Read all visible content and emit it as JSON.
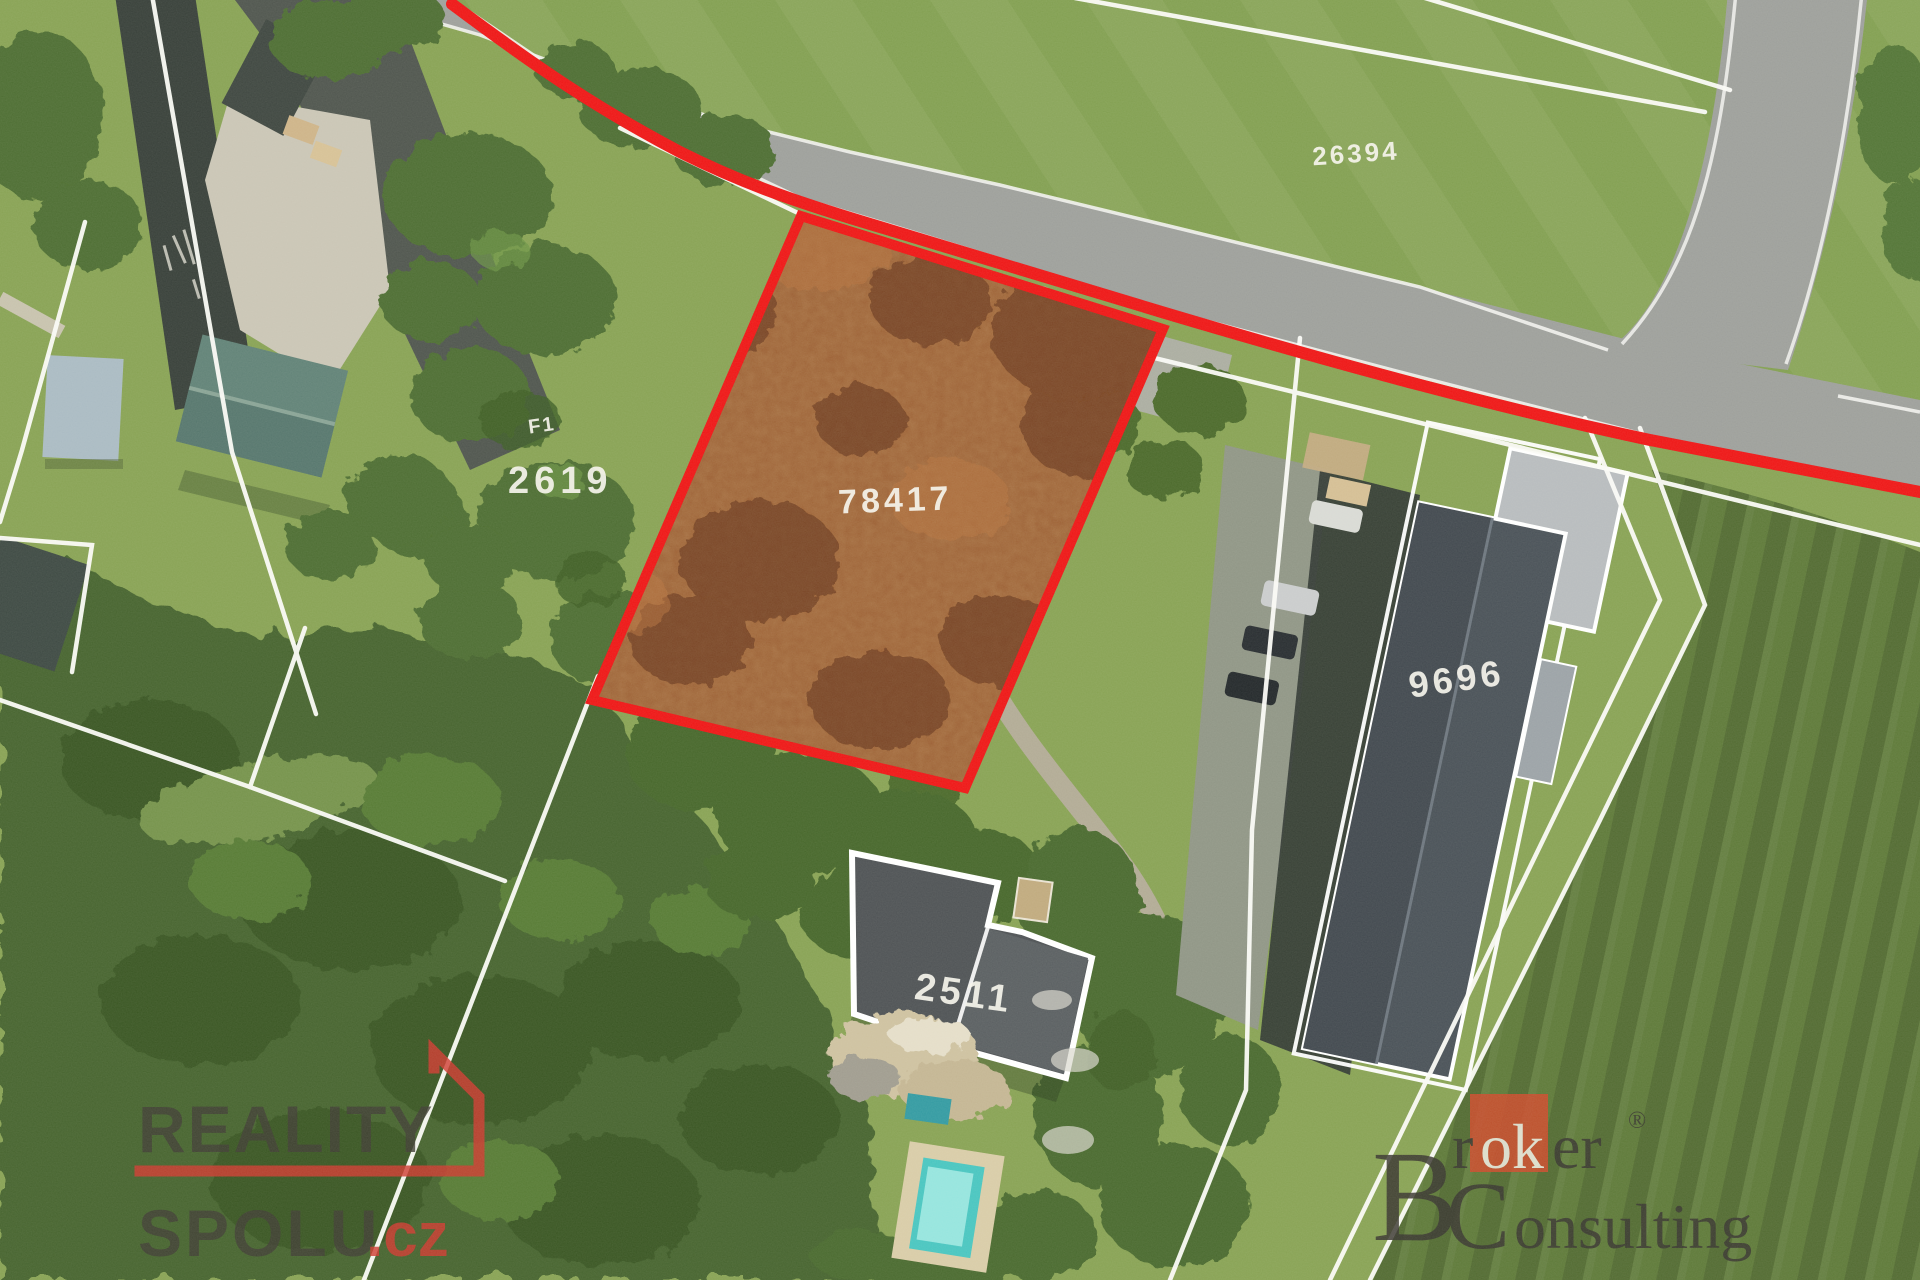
{
  "map": {
    "type": "aerial-cadastral-photo",
    "parcel_labels": {
      "top_right": "26394",
      "left": "2619",
      "highlighted": "78417",
      "building_right": "9696",
      "house_bottom": "2511",
      "small_mark": "F1"
    },
    "highlight": {
      "parcel_number": "78417",
      "outline_color": "#ee1010",
      "road_marker_color": "#ee1010",
      "fill_tint": "#915426"
    },
    "line_colors": {
      "cadastral": "#ffffff",
      "road_edge": "#f2f2ee"
    }
  },
  "watermarks": {
    "reality_spolu": {
      "line1": "REALITY",
      "line2": "SPOLU",
      "domain_suffix": ".cz",
      "accent_color": "#ce352b",
      "text_color": "#3b392f"
    },
    "broker_consulting": {
      "initial": "B",
      "part_r": "r",
      "part_ok": "ok",
      "part_er": "er",
      "registered_mark": "®",
      "initial2": "C",
      "line2_rest": "onsulting",
      "square_color": "#cc4727",
      "text_color": "#34312b"
    }
  }
}
